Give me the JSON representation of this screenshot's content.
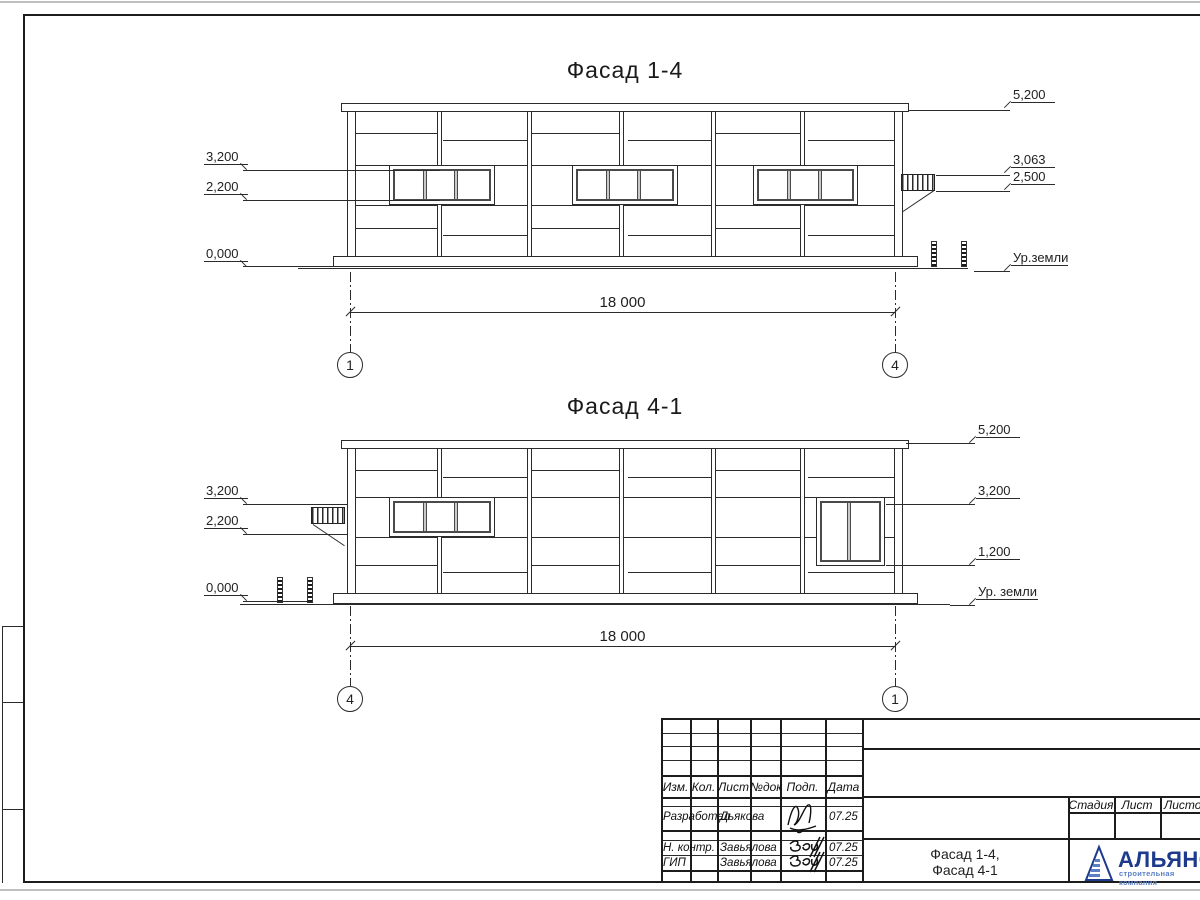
{
  "drawing": {
    "facade_top": {
      "title": "Фасад 1-4",
      "marks_left": [
        "3,200",
        "2,200",
        "0,000"
      ],
      "marks_right": [
        "5,200",
        "3,063",
        "2,500",
        "Ур.земли"
      ],
      "dimension": "18 000",
      "axis_left": "1",
      "axis_right": "4"
    },
    "facade_bottom": {
      "title": "Фасад 4-1",
      "marks_left": [
        "3,200",
        "2,200",
        "0,000"
      ],
      "marks_right": [
        "5,200",
        "3,200",
        "1,200",
        "Ур. земли"
      ],
      "dimension": "18 000",
      "axis_left": "4",
      "axis_right": "1"
    }
  },
  "title_block": {
    "revision_headers": [
      "Изм.",
      "Кол.",
      "Лист",
      "№док",
      "Подп.",
      "Дата"
    ],
    "signature_rows": [
      {
        "role": "Разработал",
        "name": "Дьякова",
        "date": "07.25"
      },
      {
        "role": "Н. контр.",
        "name": "Завьялова",
        "date": "07.25"
      },
      {
        "role": "ГИП",
        "name": "Завьялова",
        "date": "07.25"
      }
    ],
    "stage_headers": [
      "Стадия",
      "Лист",
      "Листов"
    ],
    "sheet_title": [
      "Фасад 1-4,",
      "Фасад 4-1"
    ],
    "logo": {
      "name": "АЛЬЯНС",
      "subtitle": "строительная компания"
    }
  },
  "colors": {
    "line": "#2b2b2b",
    "logo_navy": "#1d3a8c",
    "logo_blue": "#5b7fc4"
  }
}
